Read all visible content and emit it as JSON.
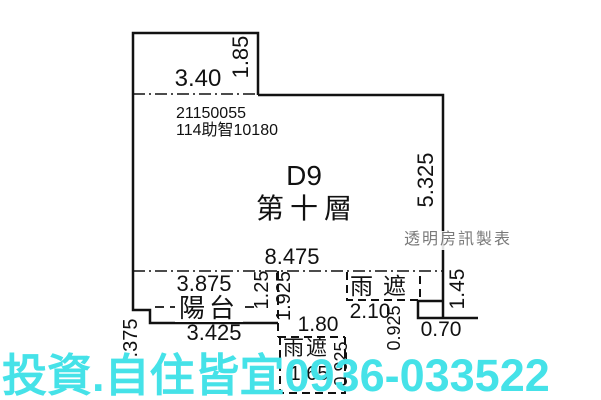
{
  "header": {
    "serial": "21150055",
    "case_number": "114助智10180",
    "unit_label": "D9",
    "floor_label": "第十層"
  },
  "rooms": {
    "balcony": "陽台",
    "canopy_bottom": "雨遮",
    "canopy_right": "雨遮"
  },
  "dimensions": {
    "top_block_width": "3.40",
    "top_block_height": "1.85",
    "right_side_height": "5.325",
    "main_width": "8.475",
    "balcony_width": "3.875",
    "balcony_depth": "1.25",
    "middle_depth": "1.925",
    "balcony_bottom_width": "3.425",
    "left_offset": ".375",
    "bottom_canopy_width": "1.80",
    "bottom_canopy_inner_width": "1.65",
    "bottom_canopy_depth": "0.925",
    "right_canopy_width": "2.10",
    "right_canopy_depth": "0.925",
    "right_step_width": "0.70",
    "right_step_height": "1.45"
  },
  "annotations": {
    "maker_credit": "透明房訊製表",
    "watermark_text": "投資.自住皆宜0936-033522"
  },
  "colors": {
    "watermark_cyan": "#45E2E8",
    "line_black": "#111111",
    "credit_gray": "#7a7a7a"
  }
}
